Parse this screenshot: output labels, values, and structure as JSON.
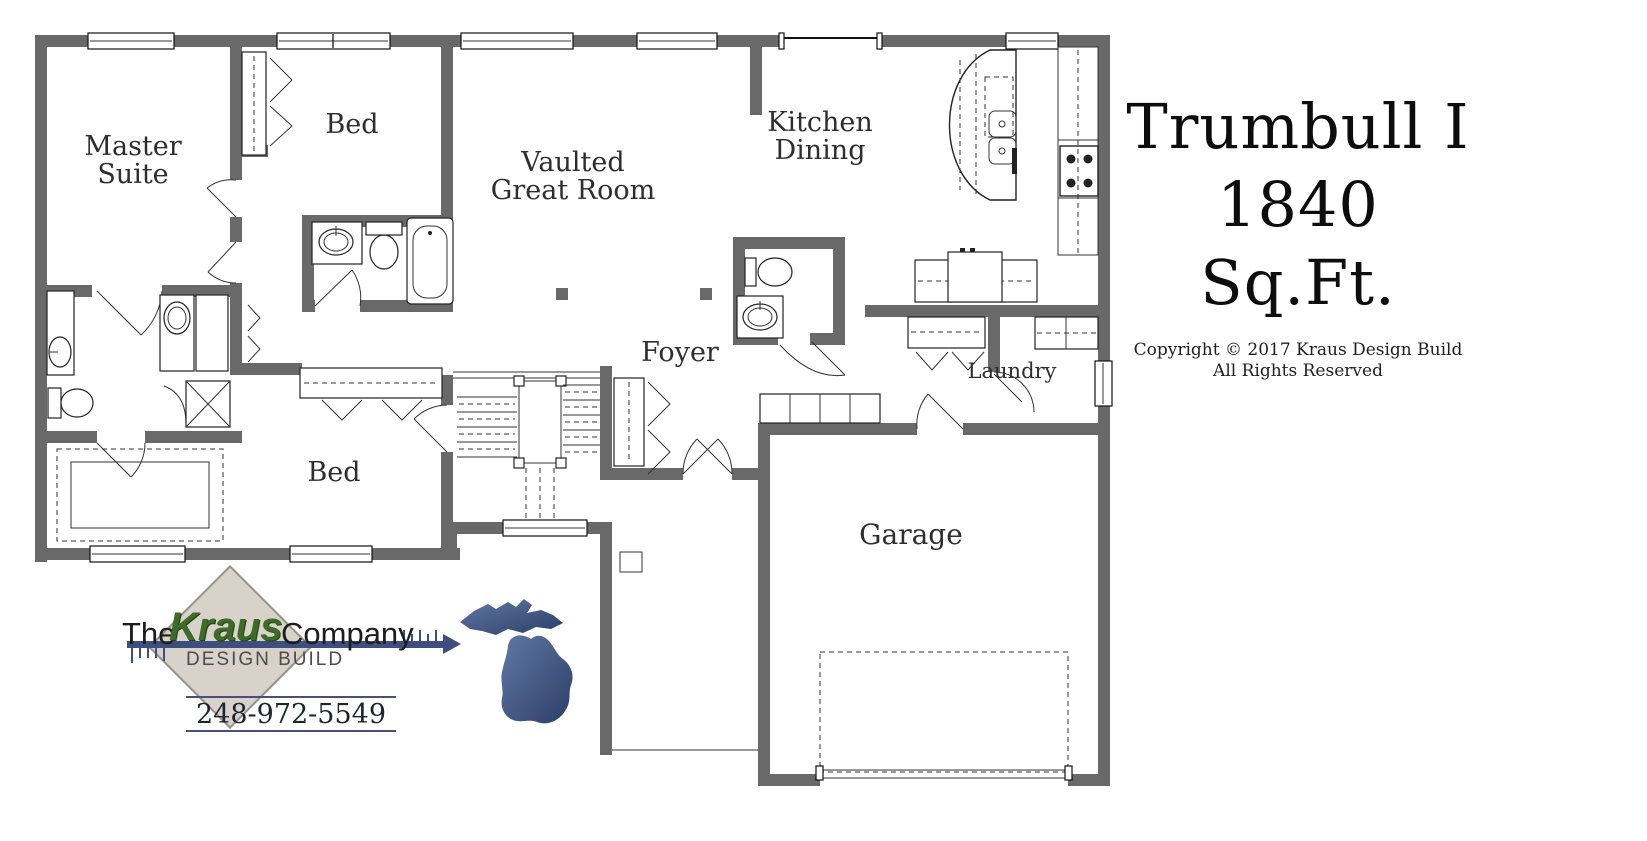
{
  "plan": {
    "rooms": {
      "master": {
        "line1": "Master",
        "line2": "Suite"
      },
      "bed_top": {
        "label": "Bed"
      },
      "great_room": {
        "line1": "Vaulted",
        "line2": "Great Room"
      },
      "kitchen": {
        "line1": "Kitchen",
        "line2": "Dining"
      },
      "foyer": {
        "label": "Foyer"
      },
      "laundry": {
        "label": "Laundry"
      },
      "bed_bottom": {
        "label": "Bed"
      },
      "garage": {
        "label": "Garage"
      }
    }
  },
  "title_block": {
    "plan_name": "Trumbull I",
    "square_footage": "1840 Sq.Ft.",
    "copyright_line1": "Copyright © 2017 Kraus Design Build",
    "copyright_line2": "All Rights Reserved"
  },
  "logo": {
    "prefix": "The",
    "name": "Kraus",
    "suffix": "Company",
    "tagline": "DESIGN BUILD",
    "phone": "248-972-5549"
  },
  "colors": {
    "wall": "#696969",
    "navy_accent": "#3e4e7e",
    "kraus_green": "#3e6b2a",
    "diamond_fill": "#d8d2ca",
    "michigan_light": "#6277a6",
    "michigan_dark": "#2c3e66"
  }
}
